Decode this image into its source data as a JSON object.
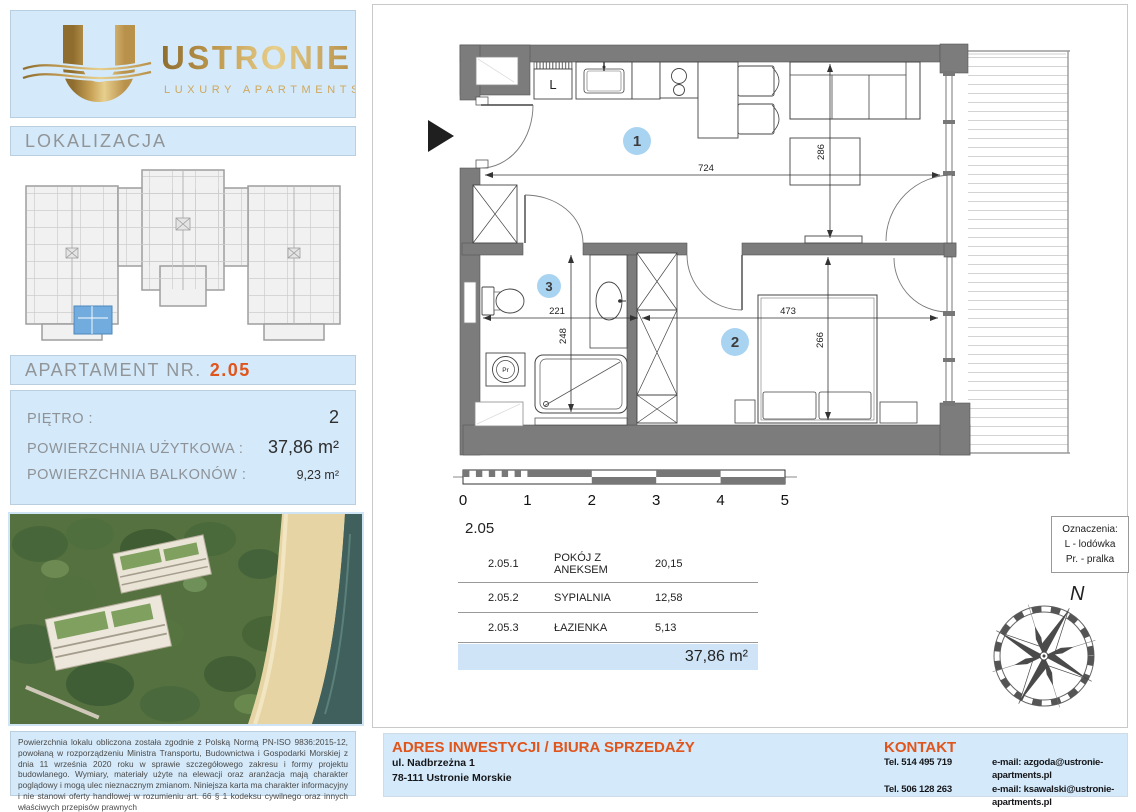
{
  "colors": {
    "panel_blue": "#d4e9f9",
    "accent_orange": "#e0551c",
    "wall_gray": "#7c7c7c",
    "marker_blue": "#a9d4f1",
    "highlight_blue": "#72abdd",
    "gold": "#c29a4a"
  },
  "logo": {
    "initial": "U",
    "brand": "USTRONIE",
    "tagline": "LUXURY APARTMENTS"
  },
  "sidebar": {
    "lokalizacja_title": "LOKALIZACJA",
    "apartment_label": "APARTAMENT NR.",
    "apartment_number": "2.05",
    "info_rows": [
      {
        "label": "PIĘTRO :",
        "value": "2"
      },
      {
        "label": "POWIERZCHNIA UŻYTKOWA :",
        "value": "37,86 m²"
      },
      {
        "label": "POWIERZCHNIA BALKONÓW :",
        "value": "9,23 m²"
      }
    ],
    "legal_text": "Powierzchnia lokalu obliczona została zgodnie z Polską Normą PN-ISO 9836:2015-12, powołaną w rozporządzeniu Ministra Transportu, Budownictwa i Gospodarki Morskiej z dnia 11 września 2020 roku w sprawie szczegółowego zakresu i formy projektu budowlanego. Wymiary, materiały użyte na elewacji oraz aranżacja mają charakter poglądowy i mogą ulec nieznacznym zmianom. Niniejsza karta ma charakter informacyjny i nie stanowi oferty handlowej w rozumieniu art. 66 § 1 kodeksu cywilnego oraz innych właściwych przepisów prawnych"
  },
  "plan": {
    "markers": [
      "1",
      "2",
      "3"
    ],
    "dims": {
      "d724": "724",
      "d286": "286",
      "d221": "221",
      "d248": "248",
      "d473": "473",
      "d266": "266"
    },
    "fridge_label": "L",
    "washer_label": "Pr"
  },
  "scalebar": {
    "labels": [
      "0",
      "1",
      "2",
      "3",
      "4",
      "5"
    ]
  },
  "rooms_table": {
    "unit": "2.05",
    "rows": [
      {
        "no": "2.05.1",
        "name": "POKÓJ Z ANEKSEM",
        "area": "20,15"
      },
      {
        "no": "2.05.2",
        "name": "SYPIALNIA",
        "area": "12,58"
      },
      {
        "no": "2.05.3",
        "name": "ŁAZIENKA",
        "area": "5,13"
      }
    ],
    "total": "37,86 m²"
  },
  "legend": {
    "title": "Oznaczenia:",
    "items": [
      "L - lodówka",
      "Pr. - pralka"
    ]
  },
  "compass": {
    "north_label": "N"
  },
  "footer": {
    "address_title": "ADRES INWESTYCJI / BIURA SPRZEDAŻY",
    "address_line1": "ul. Nadbrzeżna 1",
    "address_line2": "78-111 Ustronie Morskie",
    "contact_title": "KONTAKT",
    "rows": [
      {
        "phone": "Tel. 514 495 719",
        "email": "e-mail: azgoda@ustronie-apartments.pl"
      },
      {
        "phone": "Tel. 506 128 263",
        "email": "e-mail: ksawalski@ustronie-apartments.pl"
      }
    ]
  }
}
